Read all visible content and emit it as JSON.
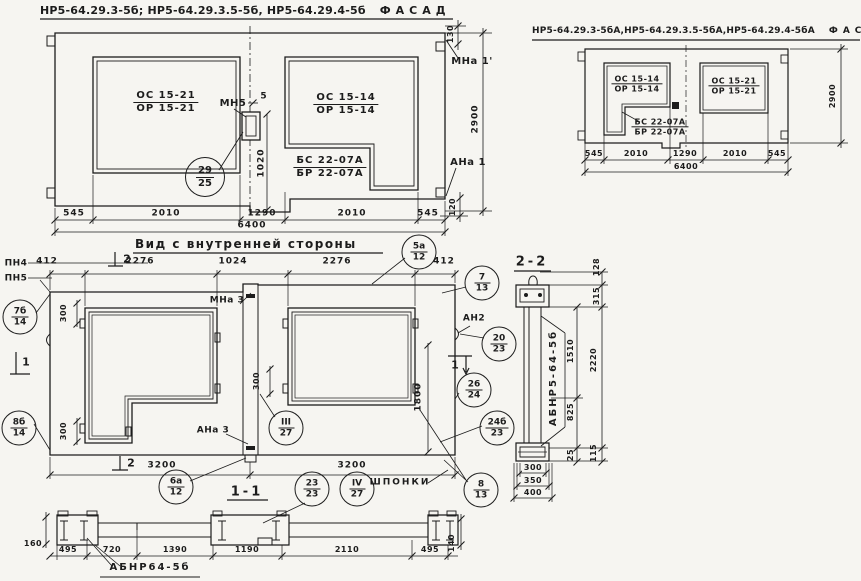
{
  "facade_a": {
    "title": "НР5-64.29.3-5б; НР5-64.29.3.5-5б, НР5-64.29.4-5б",
    "view_label": "ФАСАД",
    "win_left_frac": {
      "top": "ОС 15-21",
      "bot": "ОР 15-21"
    },
    "win_right_frac": {
      "top": "ОС 15-14",
      "bot": "ОР 15-14"
    },
    "win_right_sub": {
      "top": "БС 22-07А",
      "bot": "БР 22-07А"
    },
    "anchor_mn5": "МН5",
    "anchor_mna1": "МНа 1'",
    "anchor_ana1": "АНа 1",
    "callout": {
      "top": "29",
      "bot": "25"
    },
    "dim_5": "5",
    "dim_1020": "1020",
    "dim_130": "130",
    "dim_2900": "2900",
    "dim_120": "120",
    "dims_bottom": [
      "545",
      "2010",
      "1290",
      "2010",
      "545"
    ],
    "dim_total": "6400"
  },
  "facade_b": {
    "title": "НР5-64.29.3-5бА,НР5-64.29.3.5-5бА,НР5-64.29.4-5бА",
    "view_label": "ФАСАД",
    "win_left_frac": {
      "top": "ОС 15-14",
      "bot": "ОР 15-14"
    },
    "win_left_sub": {
      "top": "БС 22-07А",
      "bot": "БР 22-07А"
    },
    "win_right_frac": {
      "top": "ОС 15-21",
      "bot": "ОР 15-21"
    },
    "dim_2900": "2900",
    "dims_bottom": [
      "545",
      "2010",
      "1290",
      "2010",
      "545"
    ],
    "dim_total": "6400"
  },
  "inner_view": {
    "title": "Вид с внутренней стороны",
    "dims_top": [
      "412",
      "2276",
      "1024",
      "2276",
      "412"
    ],
    "dims_bottom": [
      "3200",
      "3200"
    ],
    "dim_1800": "1800",
    "dim_300": "300",
    "labels": {
      "pn4": "ПН4",
      "pn5": "ПН5",
      "mna3": "МНа 3",
      "ana3": "АНа 3",
      "an2": "АН2",
      "shponki": "ШПОНКИ"
    },
    "section_marks": {
      "s1": "1",
      "s2": "2"
    },
    "callouts": {
      "c5a": {
        "top": "5а",
        "bot": "12"
      },
      "c7": {
        "top": "7",
        "bot": "13"
      },
      "c7b": {
        "top": "7б",
        "bot": "14"
      },
      "c8b": {
        "top": "8б",
        "bot": "14"
      },
      "c20": {
        "top": "20",
        "bot": "23"
      },
      "c26": {
        "top": "26",
        "bot": "24"
      },
      "c24b": {
        "top": "24б",
        "bot": "23"
      },
      "c8": {
        "top": "8",
        "bot": "13"
      },
      "c6a": {
        "top": "6а",
        "bot": "12"
      },
      "c23": {
        "top": "23",
        "bot": "23"
      },
      "c4r": {
        "top": "IV",
        "bot": "27"
      },
      "c3r": {
        "top": "III",
        "bot": "27"
      }
    }
  },
  "section_22": {
    "title": "2-2",
    "panel_mark": "АБНР5-64-5б",
    "dims": {
      "d128": "128",
      "d315": "315",
      "d1510": "1510",
      "d2220": "2220",
      "d825": "825",
      "d25": "25",
      "d115": "115",
      "d300": "300",
      "d350": "350",
      "d400": "400"
    }
  },
  "section_11": {
    "title": "1-1",
    "panel_mark": "АБНР64-5б",
    "dims_bottom": [
      "495",
      "720",
      "1390",
      "1190",
      "2110",
      "495"
    ],
    "dim_160": "160",
    "dim_140": "140"
  }
}
